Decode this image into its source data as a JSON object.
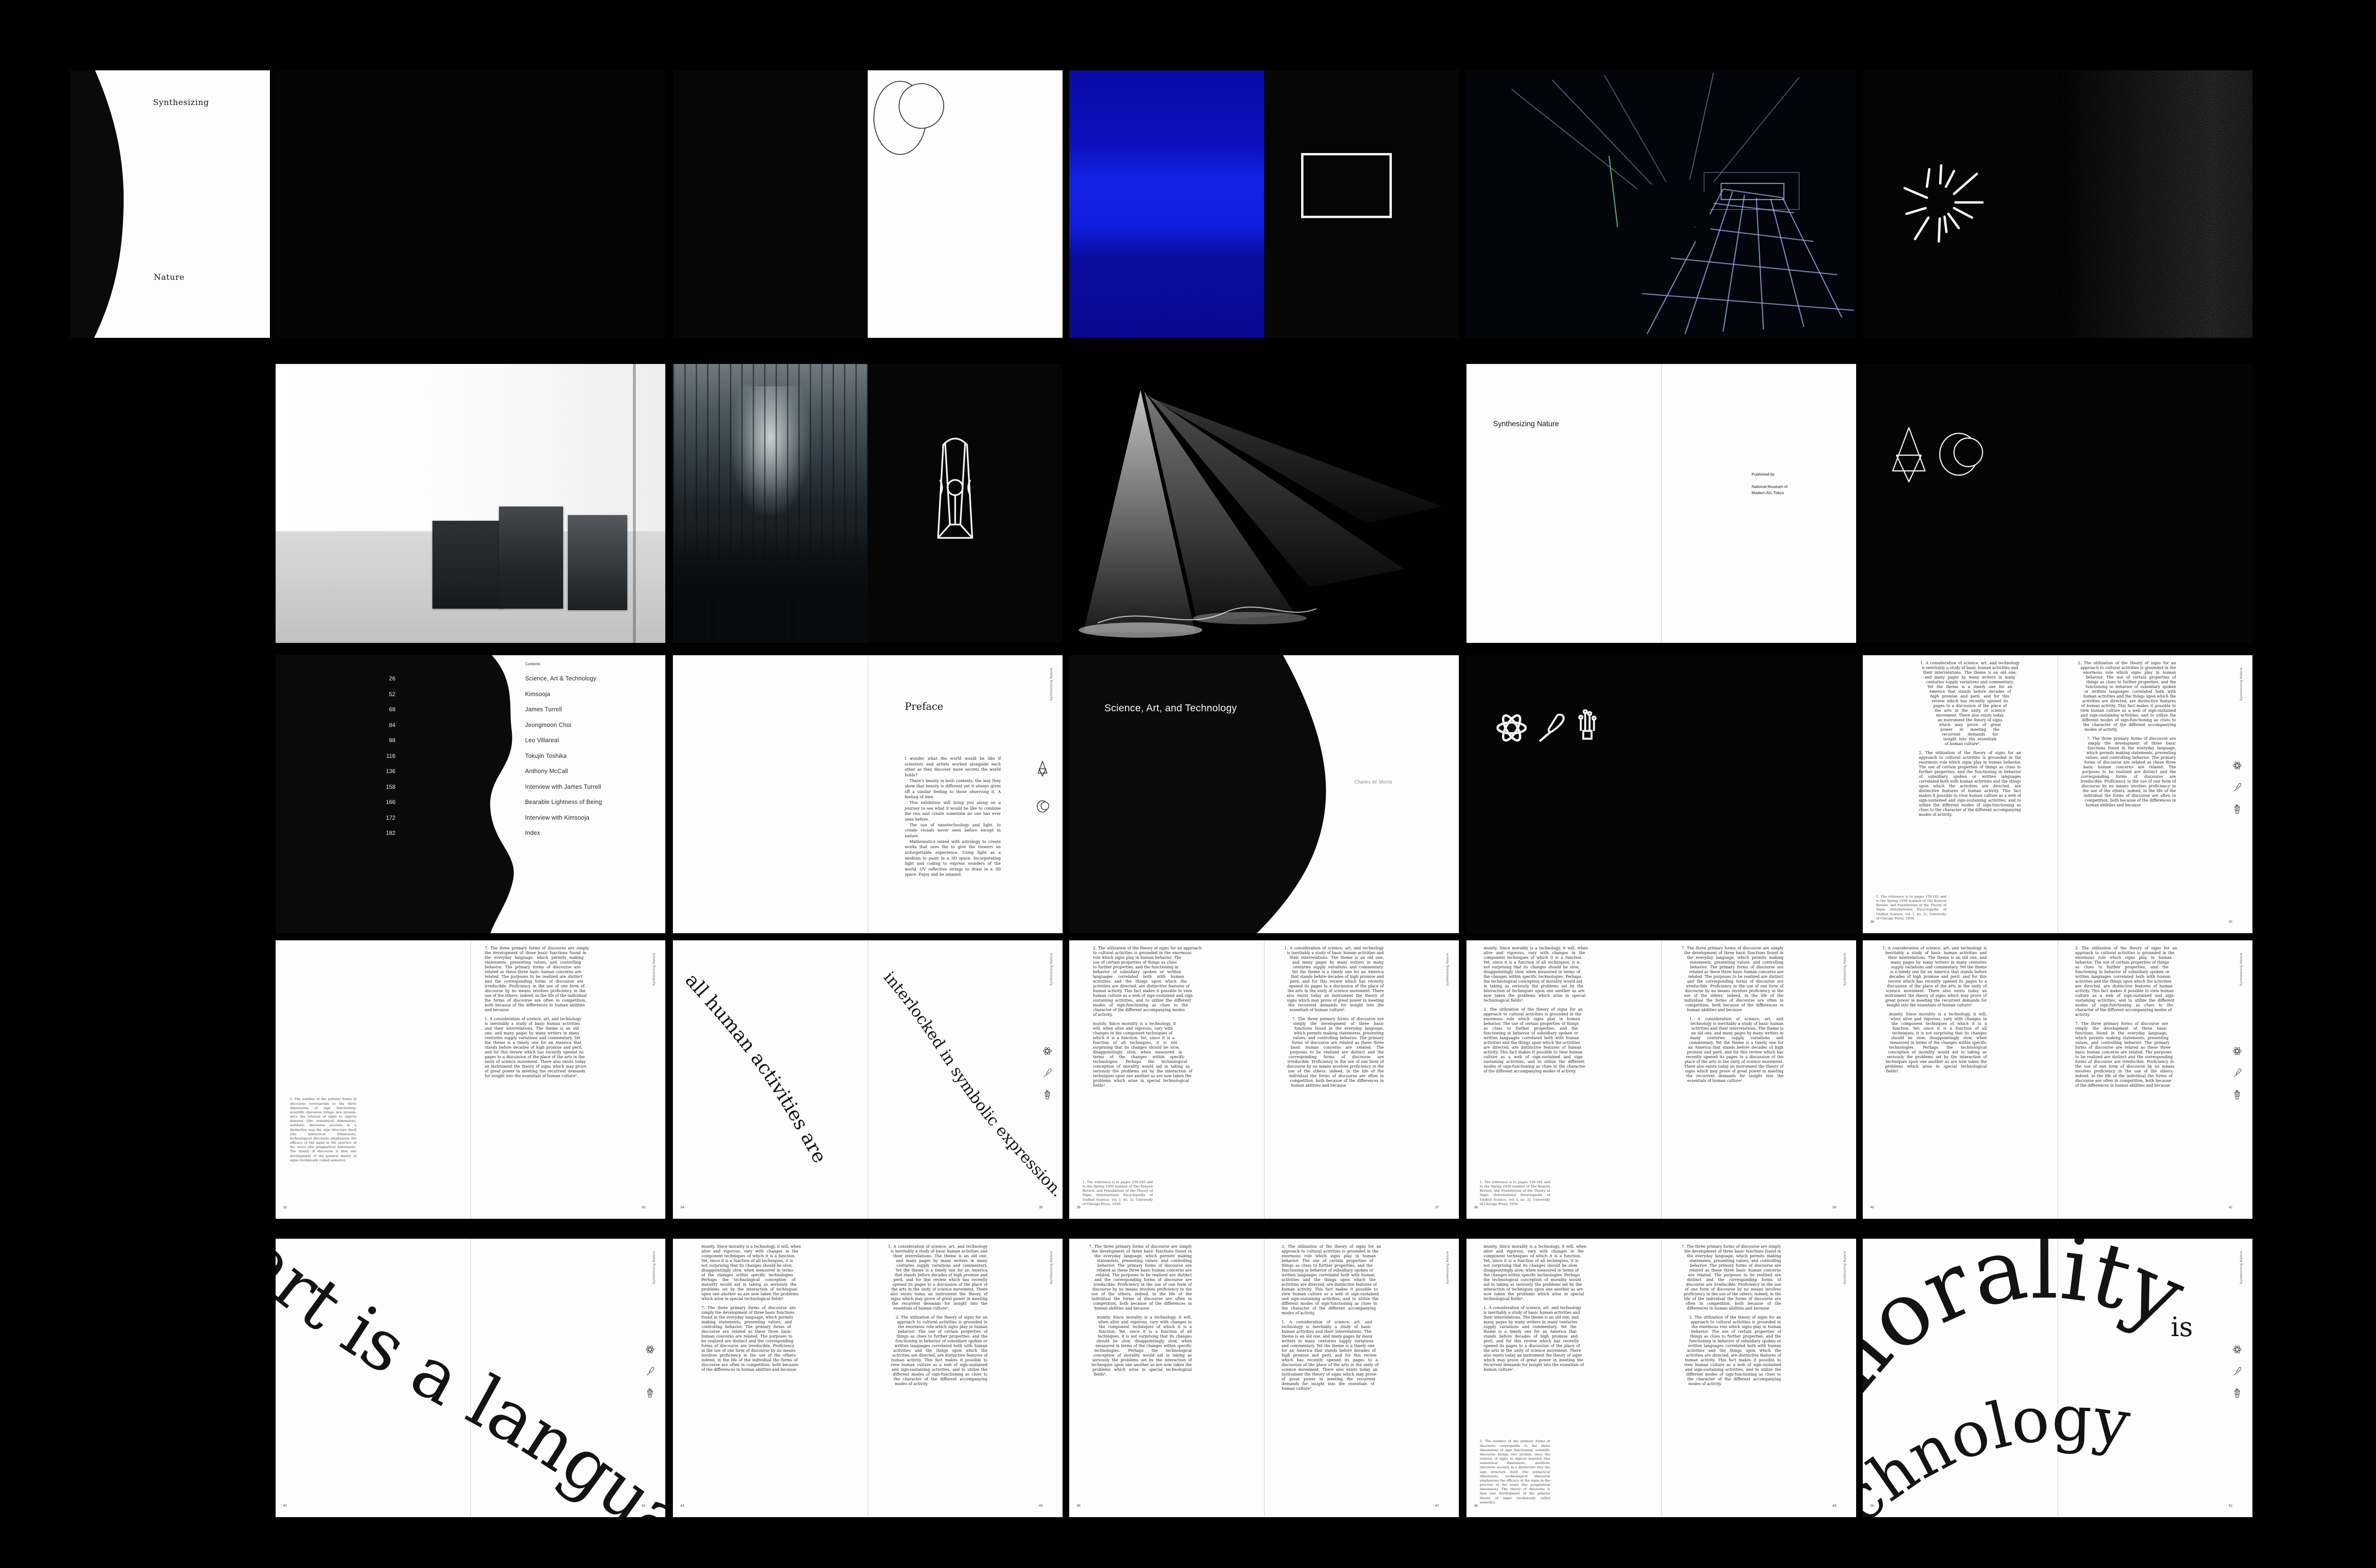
{
  "book": {
    "cover_top": "Synthesizing",
    "cover_bottom": "Nature",
    "running_head": "Synthesizing Nature"
  },
  "title_page": {
    "title": "Synthesizing Nature",
    "published_by": "Published by",
    "publisher_line1": "National Museum of",
    "publisher_line2": "Modern Art, Tokyo"
  },
  "contents": {
    "header": "Contents",
    "entries": [
      {
        "page": "26",
        "label": "Science, Art & Technology"
      },
      {
        "page": "52",
        "label": "Kimsooja"
      },
      {
        "page": "68",
        "label": "James Turrell"
      },
      {
        "page": "84",
        "label": "Jeongmoon Choi"
      },
      {
        "page": "98",
        "label": "Leo Villareal"
      },
      {
        "page": "116",
        "label": "Tokujin Toshika"
      },
      {
        "page": "136",
        "label": "Anthony McCall"
      },
      {
        "page": "158",
        "label": "Interview with James Turrell"
      },
      {
        "page": "166",
        "label": "Bearable Lightness of Being"
      },
      {
        "page": "172",
        "label": "Interview with Kimsooja"
      },
      {
        "page": "182",
        "label": "Index"
      }
    ]
  },
  "preface": {
    "heading": "Preface",
    "paragraphs": [
      "I wonder what the world would be like if scientists and artists worked alongside each other as they discover more secrets the world holds?",
      "There's beauty in both contexts, the way they show that beauty is different yet it always gives off a similar feeling to those observing it. A feeling of Awe.",
      "This exhibition will bring you along on a journey to see what it would be like to combine the two and create sometime no one has ever seen before.",
      "The use of nanotechnology and light, to create visuals never seen before except in nature.",
      "Mathematics mixed with astrology to create works that uses the to give the viewers an unforgettable experience. Using light as a medium to paint in a 3D space. Incorporating light and coding to express wonders of the world. UV reflective strings to draw in a 3D space. Enjoy and be amazed."
    ]
  },
  "chapter": {
    "title": "Science, Art, and Technology",
    "author": "Charles W. Morris"
  },
  "quotes": {
    "q34_left": "all human activities are",
    "q34_right": "interlocked in symbolic expression.",
    "q42": "art is a language",
    "q50_word1": "morality",
    "q50_word2": "is",
    "q50_word3": "technology"
  },
  "pages": {
    "p30": "30",
    "p31": "31",
    "p32": "32",
    "p33": "33",
    "p34": "34",
    "p35": "35",
    "p36": "36",
    "p37": "37",
    "p38": "38",
    "p39": "39",
    "p40": "40",
    "p41": "41",
    "p42": "42",
    "p43": "43",
    "p44": "44",
    "p45": "45",
    "p46": "46",
    "p47": "47",
    "p48": "48",
    "p49": "49",
    "p50": "50",
    "p51": "51"
  },
  "essay": {
    "texts": {
      "p1": "1. A consideration of science, art, and technology is inevitably a study of basic human activities and their interrelations. The theme is an old one, and many pages by many writers in many centuries supply variations and commentary. Yet the theme is a timely one for an America that stands before decades of high promise and peril, and for this review which has recently opened its pages to a discussion of the place of the arts in the unity of science movement. There also exists today an instrument the theory of signs which may prove of great power in meeting the recurrent demands for insight into the essentials of human culture¹.",
      "p2": "2. The utilization of the theory of signs for an approach to cultural activities is grounded in the enormous role which signs play in human behavior. The use of certain properties of things as clues to further properties, and the functioning in behavior of subsidiary spoken or written languages correlated both with human activities and the things upon which the activities are directed, are distinctive features of human activity. This fact makes it possible to view human culture as a web of sign-sustained and sign-sustaining activities, and to utilize the different modes of sign-functioning as clues to the character of the different accompanying modes of activity.",
      "p6cont": "munity. Since morality is a technology, it will, when alive and vigorous, vary with changes in the component techniques of which it is a function. Yet, since it is a function of all techniques, it is not surprising that its changes should be slow, disappointingly slow, when measured in terms of the changes within specific technologies. Perhaps the technological conception of morality would aid in taking as seriously the problems set by the interaction of techniques upon one another as are now taken the problems which arise in special technological fields⁴.",
      "p7": "7. The three primary forms of discourse are simply the development of three basic functions found in the everyday language, which permits making statements, presenting values, and controlling behavior. The primary forms of discourse are related as these three basic human concerns are related. The purposes to be realized are distinct and the corresponding forms of discourse are irreducible. Proficiency in the use of one form of discourse by no means involves proficiency in the use of the others; indeed, in the life of the individual the forms of discourse are often in competition, both because of the differences in human abilities and because",
      "fn1": "1. The reference is to pages 139-182 and to the Spring 1939 number of The Kenyon Review, and Foundations of the Theory of Signs (International Encyclopedia of Unified Science, vol. I, no. 2), University of Chicago Press, 1938.",
      "fn2": "2. The number of the primary forms of discourse corresponds to the three dimensions of sign functioning: scientific discourse brings into promin- ence the relation of signs to objects denoted (the semantical dimension), aesthetic discourse accents in a distinctive way the sign structure itself (the syntactical dimension), technological discourse emphasizes the efficacy of the signs in the practice of the users (the pragmatical dimension). The theory of discourse is thus one development of the general theory of signs (technically called semiotic)."
    },
    "columns": {
      "c30L": [
        "p1",
        "p2"
      ],
      "c30R": [
        "p2",
        "p7"
      ],
      "c33": [
        "p7",
        "p1"
      ],
      "c36L": [
        "p2",
        "p6cont"
      ],
      "c36R": [
        "p1",
        "p7"
      ],
      "c38L": [
        "p6cont",
        "p2"
      ],
      "c38R": [
        "p7",
        "p1"
      ],
      "c40L": [
        "p1",
        "p6cont"
      ],
      "c40R": [
        "p2",
        "p7"
      ],
      "c44L": [
        "p6cont",
        "p7"
      ],
      "c44R": [
        "p1",
        "p2"
      ],
      "c46L": [
        "p7",
        "p6cont"
      ],
      "c46R": [
        "p2",
        "p1"
      ],
      "c48L": [
        "p6cont",
        "p1"
      ],
      "c48R": [
        "p7",
        "p2"
      ]
    }
  }
}
